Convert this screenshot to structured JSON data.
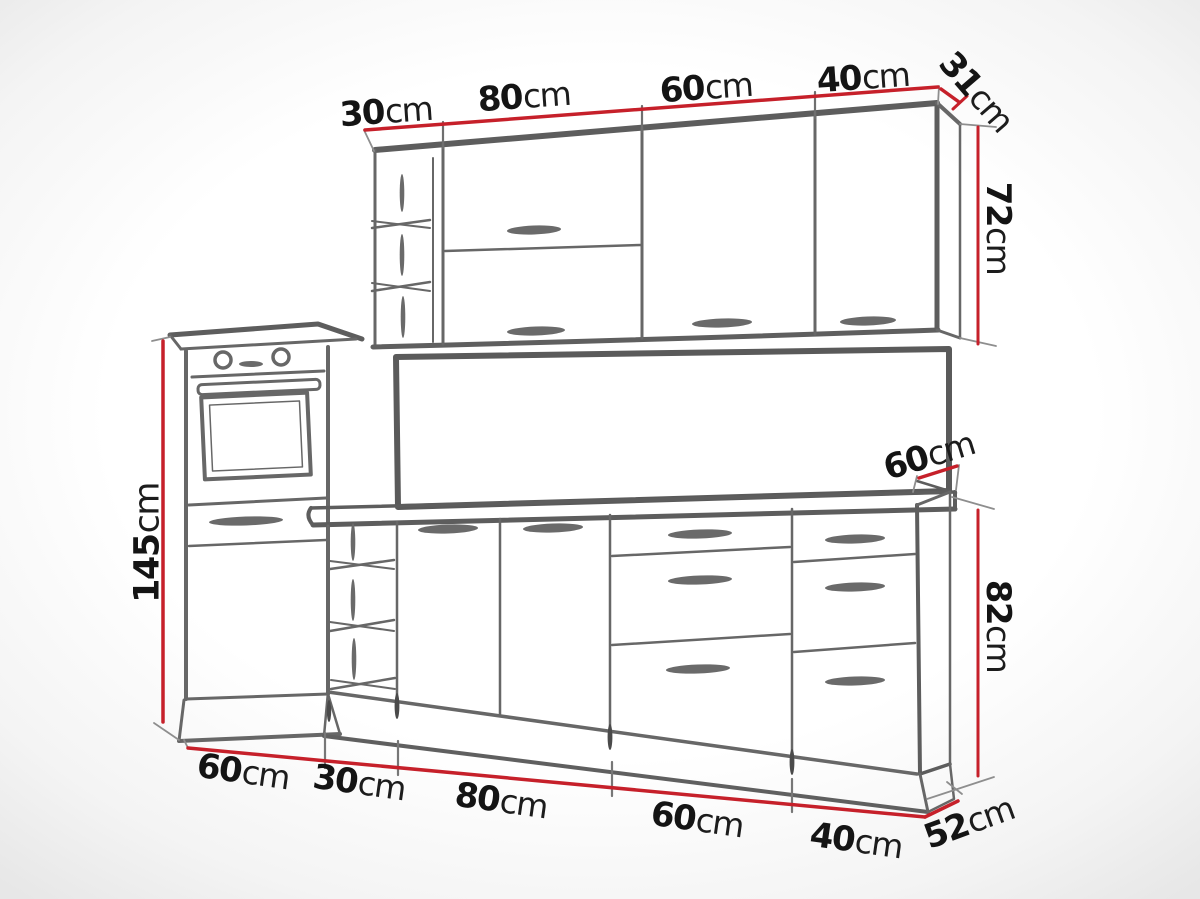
{
  "figure": {
    "kind": "kitchen-cabinet-set-dimension-diagram"
  },
  "colors": {
    "dimension_line_red": "#c6202a",
    "sketch_line_gray": "#666666",
    "label_text": "#141414",
    "background": "#ffffff"
  },
  "wall_cabinets": {
    "width_labels": [
      {
        "value": "30",
        "unit": "cm"
      },
      {
        "value": "80",
        "unit": "cm"
      },
      {
        "value": "60",
        "unit": "cm"
      },
      {
        "value": "40",
        "unit": "cm"
      }
    ],
    "depth_label": {
      "value": "31",
      "unit": "cm"
    },
    "height_label": {
      "value": "72",
      "unit": "cm"
    }
  },
  "tall_cabinet": {
    "height_label": {
      "value": "145",
      "unit": "cm"
    }
  },
  "worktop": {
    "depth_label": {
      "value": "60",
      "unit": "cm"
    }
  },
  "base_cabinets": {
    "width_labels": [
      {
        "value": "60",
        "unit": "cm"
      },
      {
        "value": "30",
        "unit": "cm"
      },
      {
        "value": "80",
        "unit": "cm"
      },
      {
        "value": "60",
        "unit": "cm"
      },
      {
        "value": "40",
        "unit": "cm"
      }
    ],
    "height_label": {
      "value": "82",
      "unit": "cm"
    },
    "depth_label": {
      "value": "52",
      "unit": "cm"
    }
  }
}
